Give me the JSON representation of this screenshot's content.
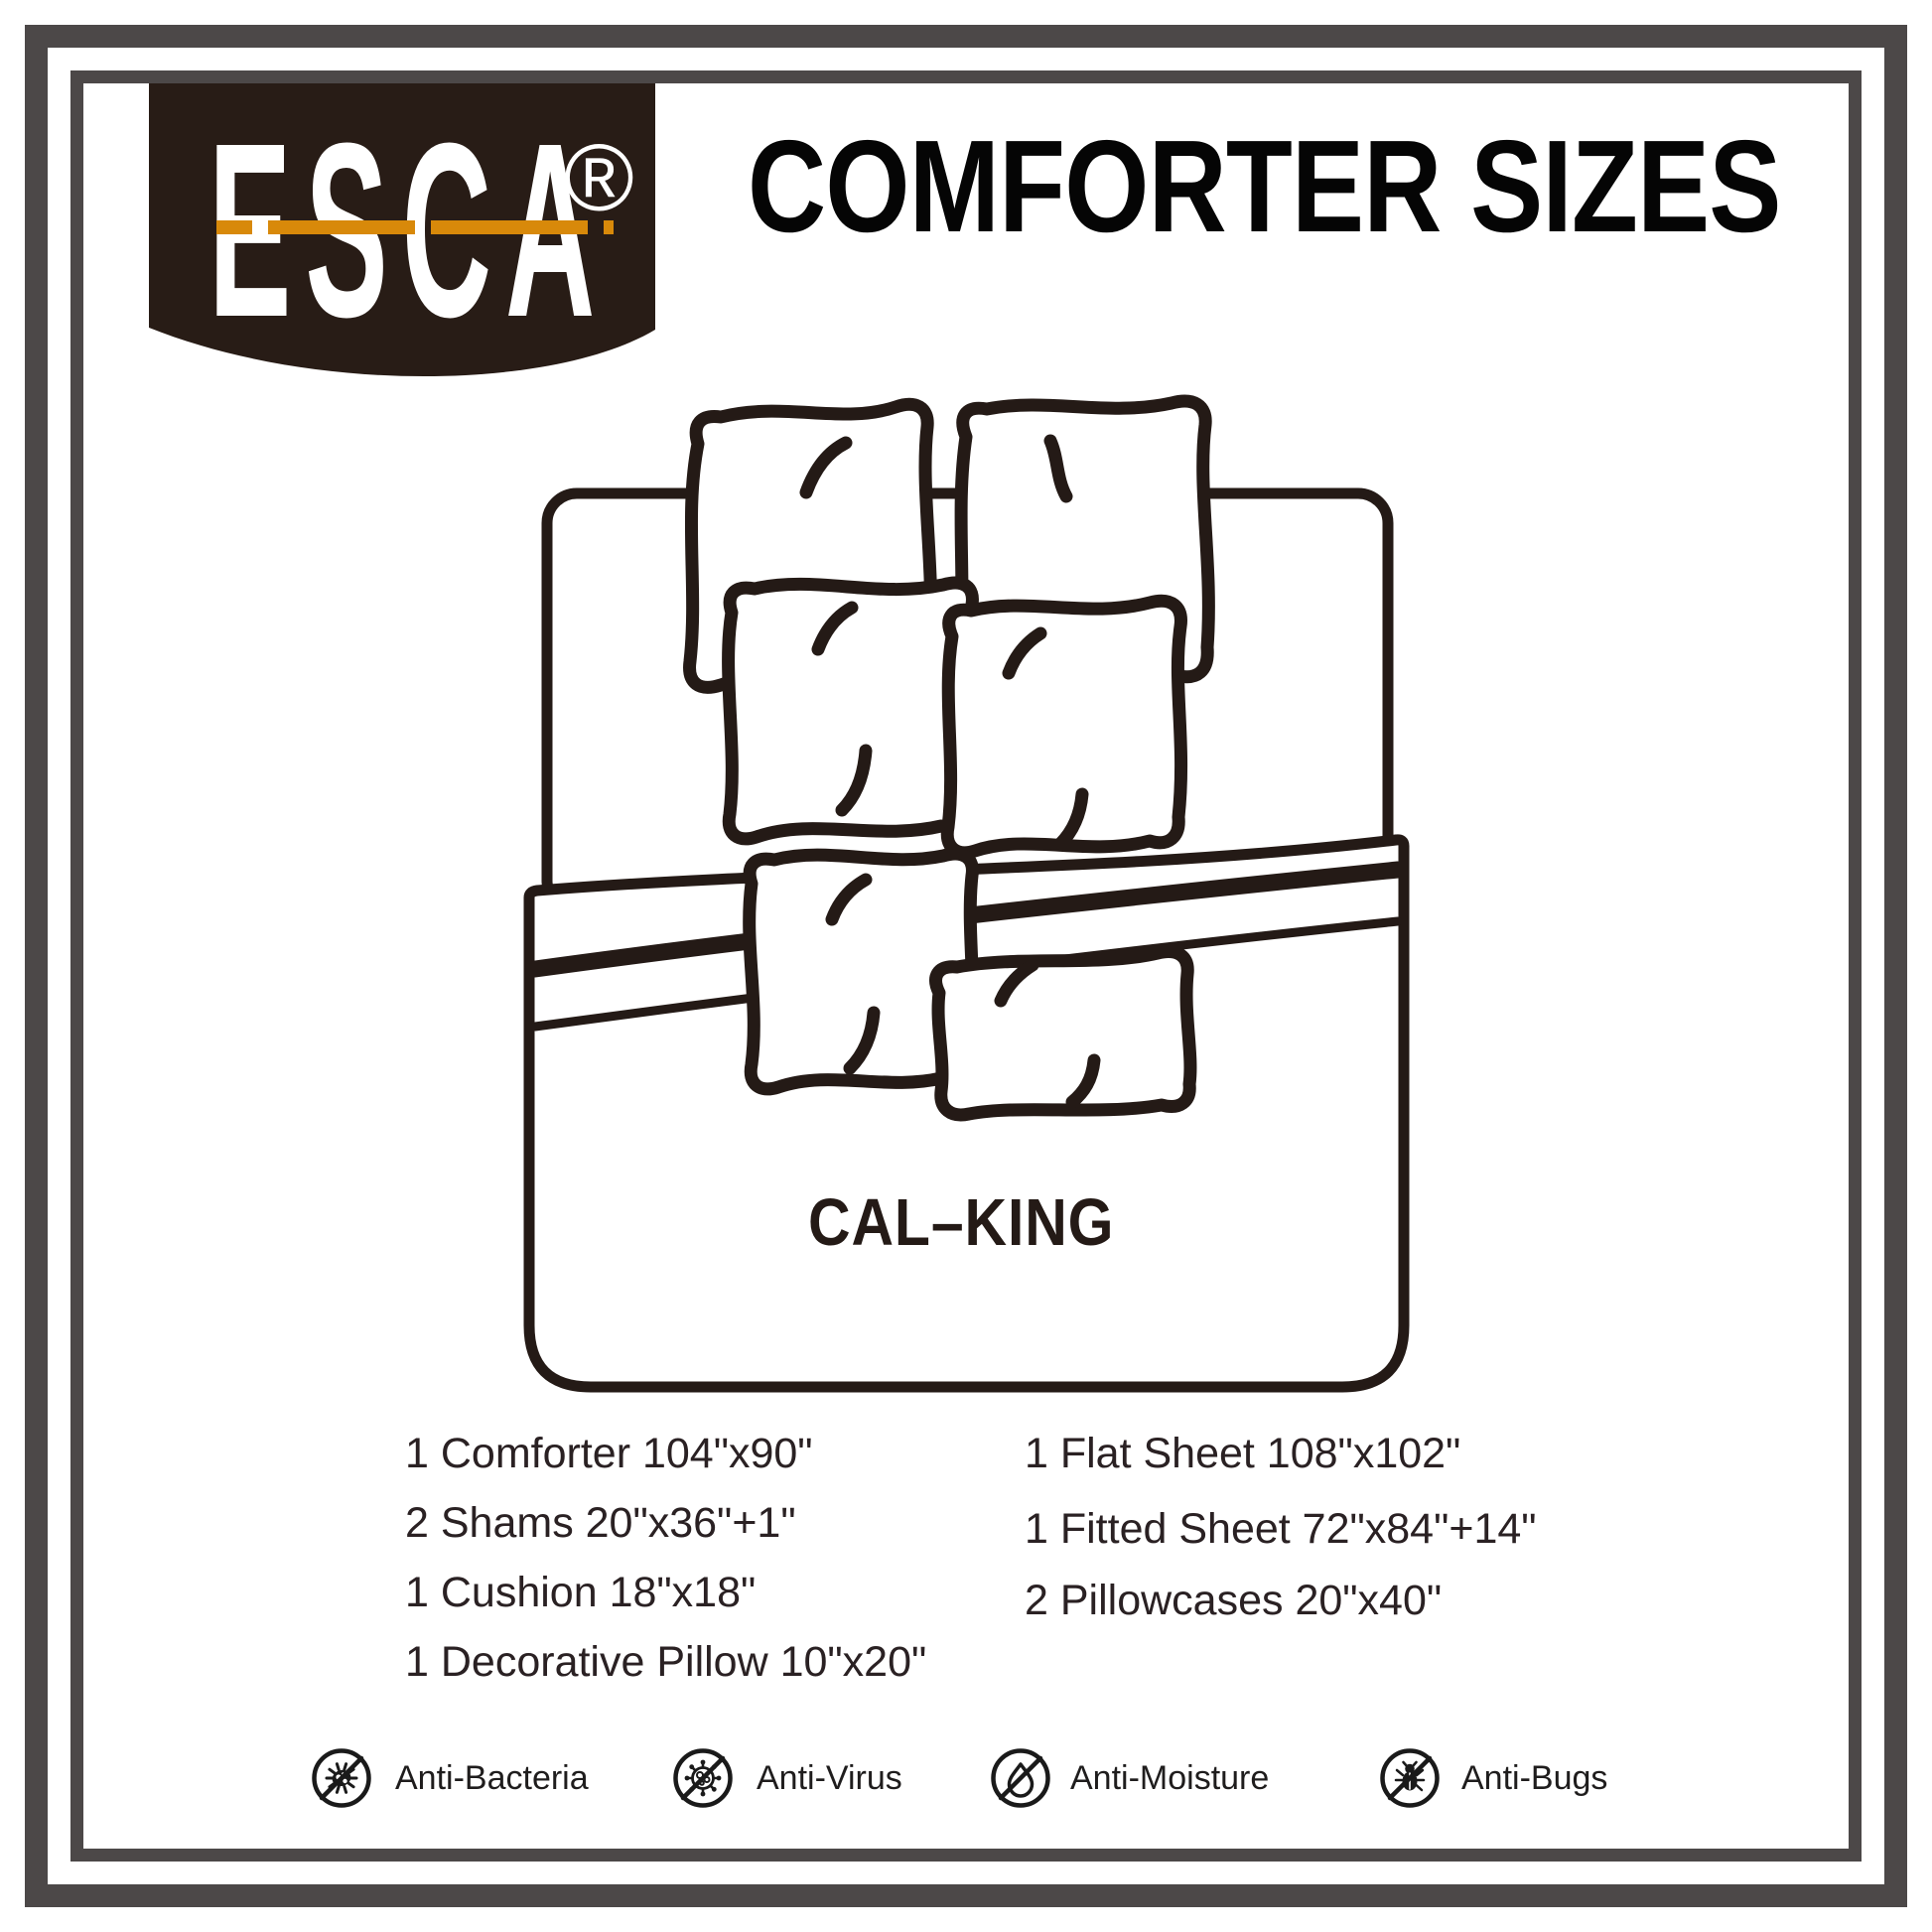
{
  "brand": {
    "logo_text": "ESCA",
    "registered_mark": "®"
  },
  "header": {
    "title": "COMFORTER SIZES"
  },
  "diagram": {
    "size_label": "CAL–KING"
  },
  "contents": {
    "left_column": [
      "1 Comforter 104\"x90\"",
      "2 Shams 20\"x36\"+1\"",
      "1 Cushion 18\"x18\"",
      "1 Decorative Pillow 10\"x20\""
    ],
    "right_column": [
      "1 Flat Sheet 108\"x102\"",
      "1 Fitted Sheet 72\"x84\"+14\"",
      "2 Pillowcases 20\"x40\""
    ]
  },
  "features": [
    {
      "icon": "anti-bacteria-icon",
      "label": "Anti-Bacteria"
    },
    {
      "icon": "anti-virus-icon",
      "label": "Anti-Virus"
    },
    {
      "icon": "anti-moisture-icon",
      "label": "Anti-Moisture"
    },
    {
      "icon": "anti-bugs-icon",
      "label": "Anti-Bugs"
    }
  ],
  "colors": {
    "badge_brown": "#281c16",
    "accent_orange": "#d8890a",
    "border_gray": "#4c4848",
    "ink": "#241a16",
    "text_dark": "#2a2123"
  }
}
